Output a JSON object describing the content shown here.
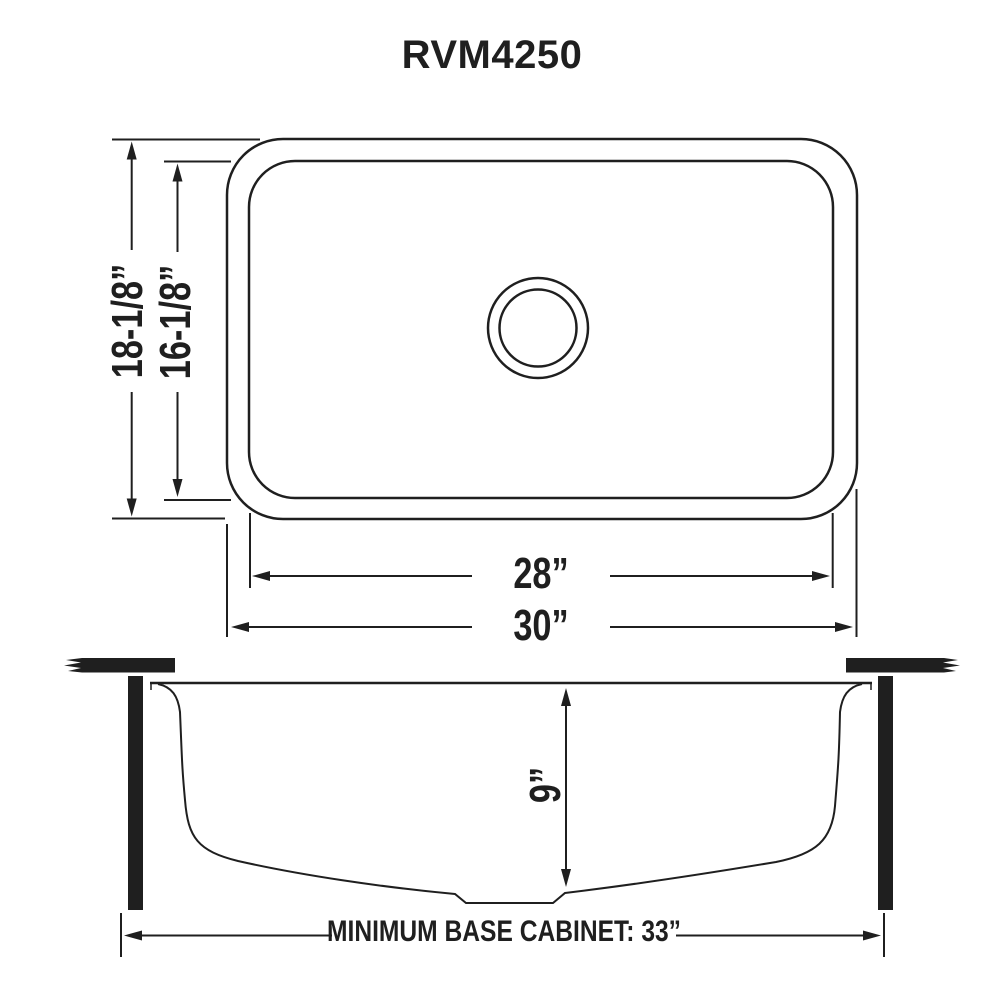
{
  "title": "RVM4250",
  "colors": {
    "ink": "#1f1f1f",
    "background": "#ffffff"
  },
  "top_view": {
    "overall_height": "18-1/8”",
    "bowl_height": "16-1/8”",
    "bowl_width": "28”",
    "overall_width": "30”"
  },
  "side_view": {
    "bowl_depth": "9”",
    "base_cabinet": "MINIMUM BASE CABINET: 33”"
  }
}
